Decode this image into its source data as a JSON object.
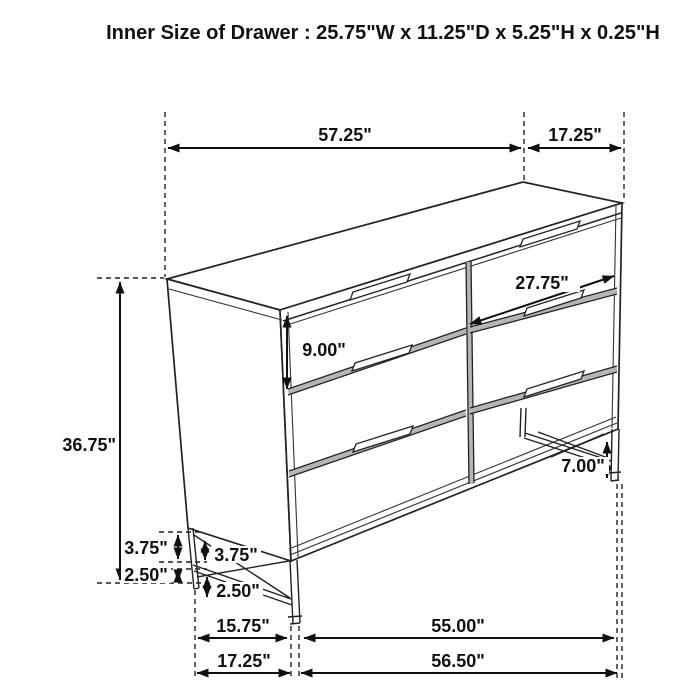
{
  "title": "Inner Size of Drawer : 25.75\"W x 11.25\"D x 5.25\"H x 0.25\"H",
  "diagram": {
    "object": "six-drawer-dresser-dimension-diagram",
    "background": "#ffffff",
    "line_color": "#222222",
    "dimensions": {
      "top_width": "57.25\"",
      "top_depth": "17.25\"",
      "drawer_width": "27.75\"",
      "drawer_front_height": "9.00\"",
      "overall_height": "36.75\"",
      "base_gap_outer": "3.75\"",
      "base_gap_inner": "3.75\"",
      "foot_height_outer": "2.50\"",
      "foot_height_inner": "2.50\"",
      "leg_height": "7.00\"",
      "base_depth_inner": "15.75\"",
      "base_depth_outer": "17.25\"",
      "base_width_inner": "55.00\"",
      "base_width_outer": "56.50\""
    }
  }
}
